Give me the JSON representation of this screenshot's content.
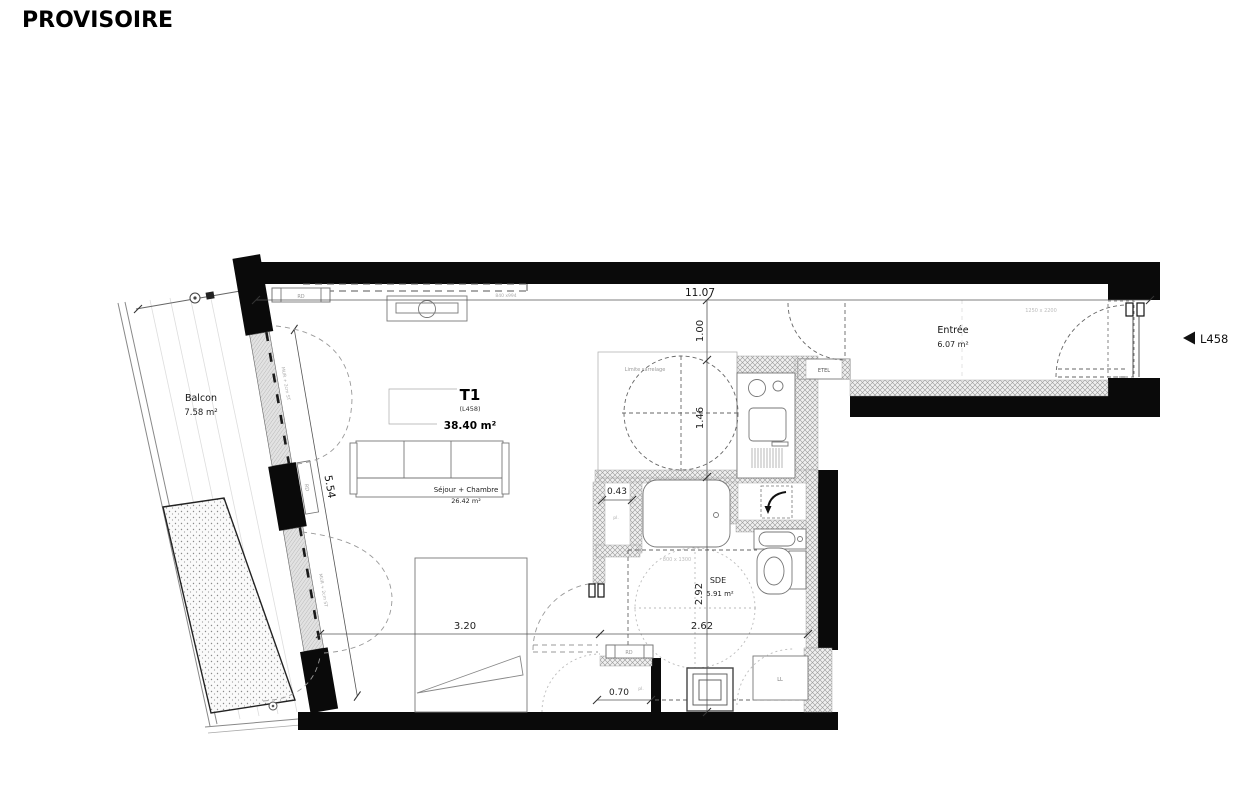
{
  "watermark": "PROVISOIRE",
  "unit": {
    "type": "T1",
    "lot": "(L458)",
    "area": "38.40 m²"
  },
  "marker": {
    "label": "L458"
  },
  "rooms": {
    "balcon": {
      "name": "Balcon",
      "area": "7.58 m²"
    },
    "sejour": {
      "name": "Séjour + Chambre",
      "area": "26.42 m²"
    },
    "entree": {
      "name": "Entrée",
      "area": "6.07 m²"
    },
    "sde": {
      "name": "SDE",
      "area": "5.91 m²"
    }
  },
  "dims": {
    "d1107": "11.07",
    "d100": "1.00",
    "d146": "1.46",
    "d292": "2.92",
    "d320": "3.20",
    "d262": "2.62",
    "d043": "0.43",
    "d070": "0.70",
    "d554": "5.54"
  },
  "labels": {
    "etel": "ETEL",
    "ll": "LL",
    "rd": "RD",
    "pl": "pl.",
    "limite": "Limite carrelage",
    "win": "1250 x 2200",
    "shower": "800 x 1300",
    "soffit": "840 x994",
    "wallnote": "MUR + 2cm ST"
  },
  "colors": {
    "wall": "#0a0a0a",
    "paper": "#ffffff"
  }
}
